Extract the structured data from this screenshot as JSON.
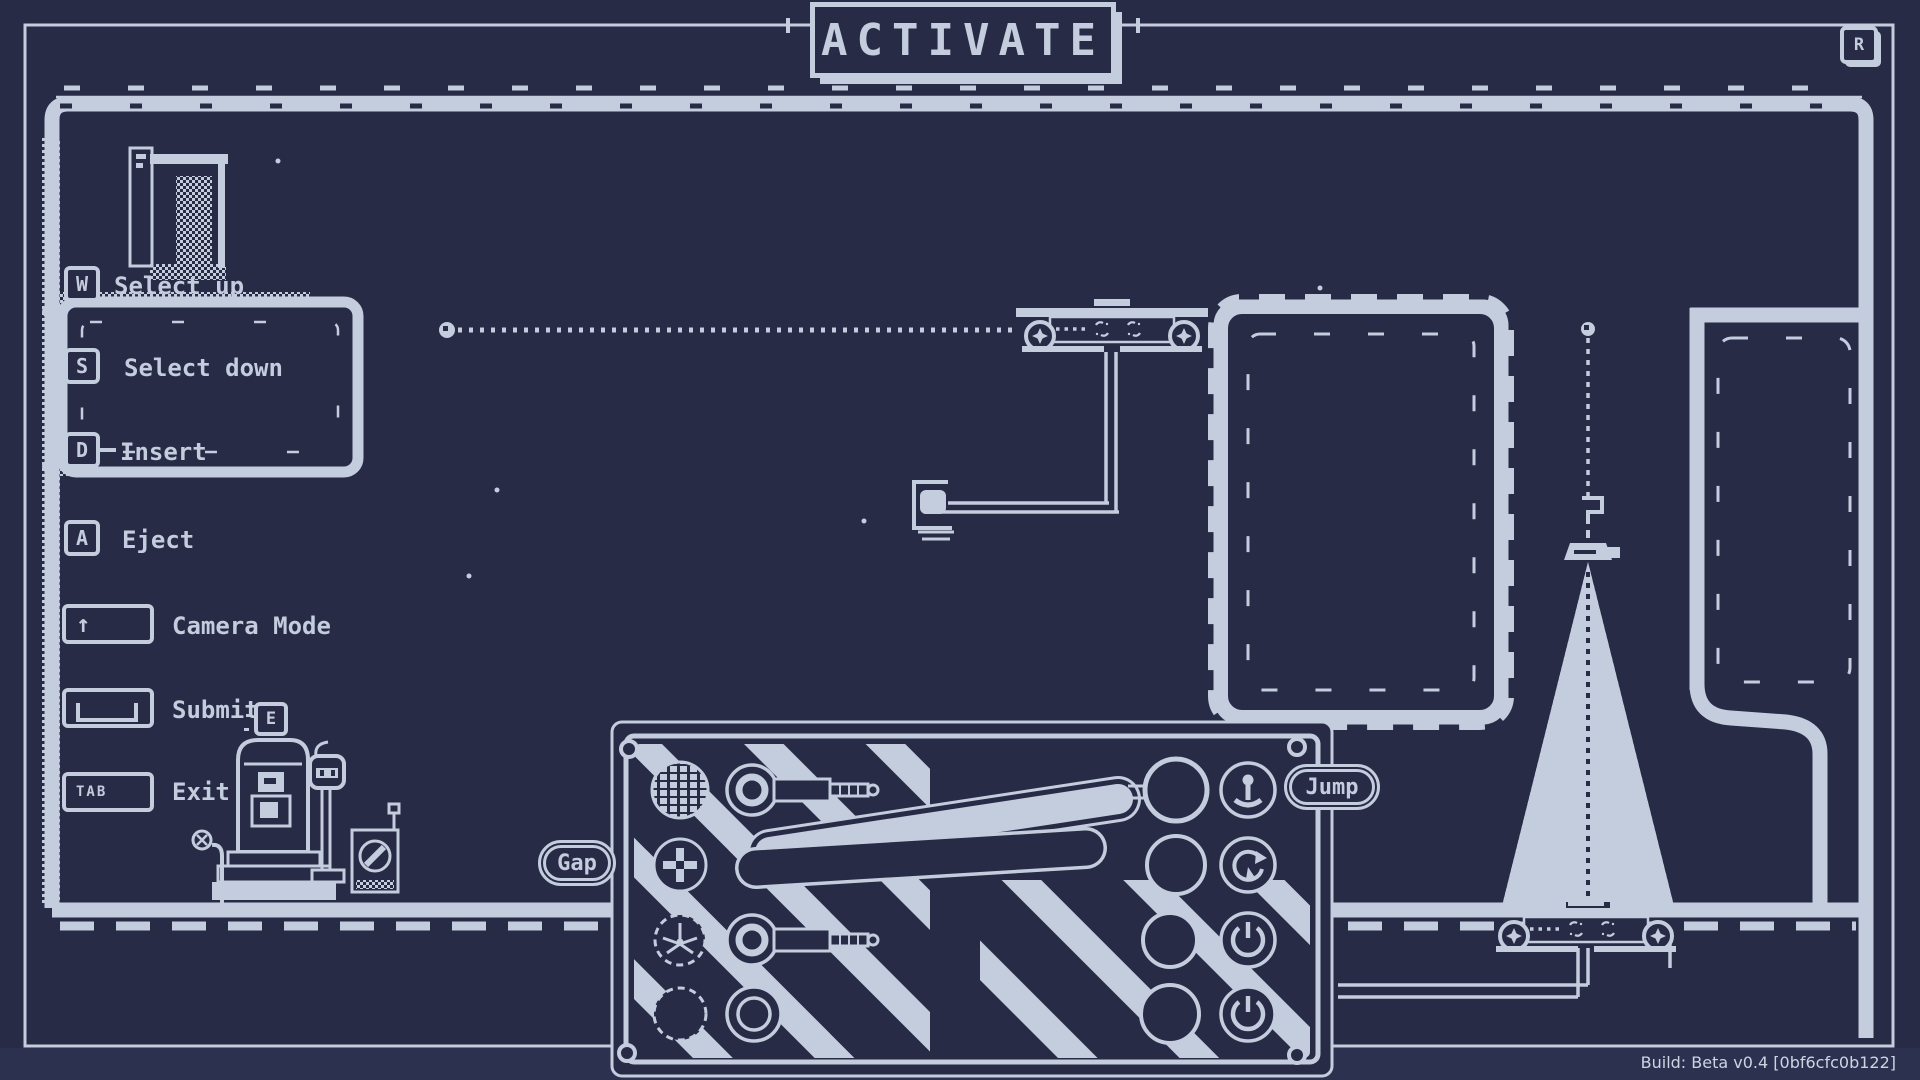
{
  "title": "ACTIVATE",
  "top_right_key": "R",
  "interact_key": "E",
  "legend": {
    "items": [
      {
        "key": "W",
        "label": "Select up"
      },
      {
        "key": "S",
        "label": "Select down"
      },
      {
        "key": "D",
        "label": "Insert"
      },
      {
        "key": "A",
        "label": "Eject"
      },
      {
        "key": "↑",
        "label": "Camera Mode"
      },
      {
        "key": "",
        "label": "Submit"
      },
      {
        "key": "TAB",
        "label": "Exit"
      }
    ]
  },
  "panel": {
    "left_label": "Gap",
    "right_label": "Jump"
  },
  "build": "Build: Beta v0.4 [0bf6cfc0b122]",
  "colors": {
    "bg": "#272b45",
    "ink": "#c3cdde",
    "strip": "#2c3150"
  }
}
